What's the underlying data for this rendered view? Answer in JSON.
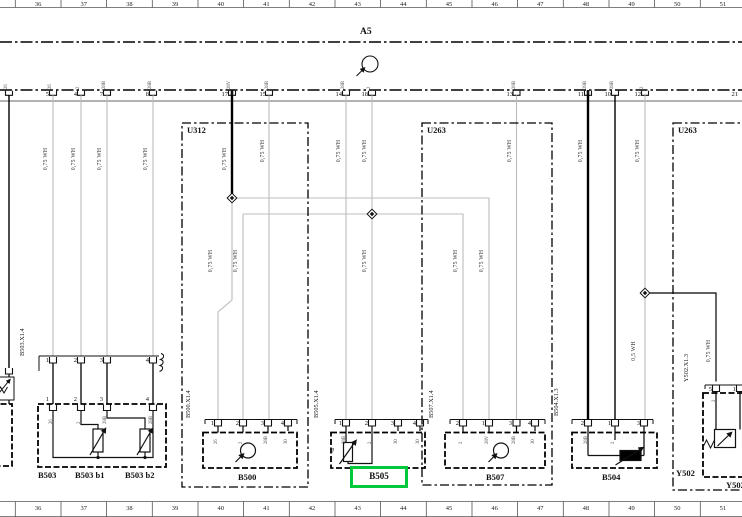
{
  "colors": {
    "highlight_green": "#00c83c",
    "wire_gray": "#bcbcbc",
    "wire_black": "#000000"
  },
  "ruler": {
    "top": [
      "36",
      "37",
      "38",
      "39",
      "40",
      "41",
      "42",
      "43",
      "44",
      "45",
      "46",
      "47",
      "48",
      "49",
      "50",
      "51"
    ],
    "bottom": [
      "36",
      "37",
      "38",
      "39",
      "40",
      "41",
      "42",
      "43",
      "44",
      "45",
      "46",
      "47",
      "48",
      "49",
      "50",
      "51"
    ]
  },
  "a5": {
    "label": "A5",
    "pins": [
      {
        "n": "5",
        "x": 53
      },
      {
        "n": "4",
        "x": 81
      },
      {
        "n": "7",
        "x": 107
      },
      {
        "n": "8",
        "x": 153
      },
      {
        "n": "17",
        "x": 232
      },
      {
        "n": "15",
        "x": 270
      },
      {
        "n": "14",
        "x": 346
      },
      {
        "n": "18",
        "x": 372
      },
      {
        "n": "13",
        "x": 517
      },
      {
        "n": "11",
        "x": 588
      },
      {
        "n": "10",
        "x": 615
      },
      {
        "n": "12",
        "x": 645
      },
      {
        "n": "21",
        "x": 742
      }
    ],
    "pin_codes": [
      {
        "t": "26",
        "x": 9
      },
      {
        "t": "26",
        "x": 53
      },
      {
        "t": "2",
        "x": 81
      },
      {
        "t": "28B",
        "x": 107
      },
      {
        "t": "28B",
        "x": 153
      },
      {
        "t": "28V",
        "x": 232
      },
      {
        "t": "28B",
        "x": 270
      },
      {
        "t": "28B",
        "x": 346
      },
      {
        "t": "2",
        "x": 372
      },
      {
        "t": "28B",
        "x": 517
      },
      {
        "t": "28B",
        "x": 588
      },
      {
        "t": "28B",
        "x": 615
      },
      {
        "t": "2",
        "x": 645
      }
    ]
  },
  "wire_labels": [
    {
      "t": "0,75 WH",
      "x": 53,
      "y": 160
    },
    {
      "t": "0,75 WH",
      "x": 81,
      "y": 160
    },
    {
      "t": "0,75 WH",
      "x": 107,
      "y": 160
    },
    {
      "t": "0,75 WH",
      "x": 153,
      "y": 160
    },
    {
      "t": "0,75 WH",
      "x": 232,
      "y": 160
    },
    {
      "t": "0,75 WH",
      "x": 270,
      "y": 152
    },
    {
      "t": "0,75 WH",
      "x": 346,
      "y": 152
    },
    {
      "t": "0,75 WH",
      "x": 372,
      "y": 152
    },
    {
      "t": "0,75 WH",
      "x": 218,
      "y": 262
    },
    {
      "t": "0,75 WH",
      "x": 243,
      "y": 262
    },
    {
      "t": "0,75 WH",
      "x": 372,
      "y": 262
    },
    {
      "t": "0,75 WH",
      "x": 463,
      "y": 262
    },
    {
      "t": "0,75 WH",
      "x": 489,
      "y": 262
    },
    {
      "t": "0,75 WH",
      "x": 517,
      "y": 152
    },
    {
      "t": "0,75 WH",
      "x": 588,
      "y": 152
    },
    {
      "t": "0,75 WH",
      "x": 645,
      "y": 152
    },
    {
      "t": "0,5 WH",
      "x": 641,
      "y": 352
    },
    {
      "t": "0,75 WH",
      "x": 716,
      "y": 352
    }
  ],
  "u_boxes": {
    "u312": "U312",
    "u263_mid": "U263",
    "u263_right": "U263"
  },
  "components": {
    "b503": {
      "connector_label": "B503.X1.4",
      "bar_pins": [
        {
          "n": "1",
          "x": 53
        },
        {
          "n": "2",
          "x": 81
        },
        {
          "n": "3",
          "x": 107
        },
        {
          "n": "4",
          "x": 153
        }
      ],
      "box_pins": [
        {
          "n": "1",
          "x": 53
        },
        {
          "n": "2",
          "x": 81
        },
        {
          "n": "3",
          "x": 107
        },
        {
          "n": "4",
          "x": 153
        }
      ],
      "pin_codes": [
        {
          "t": "26",
          "x": 53
        },
        {
          "t": "2",
          "x": 81
        },
        {
          "t": "28B",
          "x": 107
        },
        {
          "t": "28B",
          "x": 153
        }
      ],
      "names": [
        "B503",
        "B503 b1",
        "B503 b2"
      ]
    },
    "b500": {
      "connector_label": "B500.X1.4",
      "pins": [
        {
          "n": "1",
          "x": 218
        },
        {
          "n": "2",
          "x": 243
        },
        {
          "n": "3",
          "x": 268
        },
        {
          "n": "4",
          "x": 288
        }
      ],
      "pin_codes": [
        {
          "t": "26",
          "x": 218
        },
        {
          "t": "2",
          "x": 243
        },
        {
          "t": "28B",
          "x": 268
        },
        {
          "t": "30",
          "x": 288
        }
      ],
      "name": "B500"
    },
    "b505": {
      "connector_label": "B505.X1.4",
      "pins": [
        {
          "n": "1",
          "x": 346
        },
        {
          "n": "2",
          "x": 372
        },
        {
          "n": "3",
          "x": 398
        },
        {
          "n": "4",
          "x": 420
        }
      ],
      "pin_codes": [
        {
          "t": "28B",
          "x": 346
        },
        {
          "t": "2",
          "x": 372
        },
        {
          "t": "30",
          "x": 398
        },
        {
          "t": "30",
          "x": 420
        }
      ],
      "name": "B505",
      "highlighted": true
    },
    "b507": {
      "connector_label": "B507.X1.4",
      "pins": [
        {
          "n": "2",
          "x": 463
        },
        {
          "n": "1",
          "x": 489
        },
        {
          "n": "3",
          "x": 516
        },
        {
          "n": "4",
          "x": 535
        }
      ],
      "pin_codes": [
        {
          "t": "2",
          "x": 463
        },
        {
          "t": "28V",
          "x": 489
        },
        {
          "t": "28B",
          "x": 516
        },
        {
          "t": "30",
          "x": 535
        }
      ],
      "name": "B507"
    },
    "b504": {
      "connector_label": "B504.X1.3",
      "pins": [
        {
          "n": "2",
          "x": 588
        },
        {
          "n": "1",
          "x": 615
        },
        {
          "n": "3",
          "x": 644
        }
      ],
      "pin_codes": [
        {
          "t": "28B",
          "x": 588
        },
        {
          "t": "2",
          "x": 615
        }
      ],
      "name": "B504"
    },
    "y502": {
      "connector_label": "Y502.X1.3",
      "pins": [
        {
          "n": "5",
          "x": 716
        },
        {
          "n": "1",
          "x": 740
        }
      ],
      "pin_codes": [
        {
          "t": "2",
          "x": 716
        }
      ],
      "name": "Y502",
      "name_right": "Y502"
    }
  },
  "symbols": {
    "theta": "ϑ"
  }
}
